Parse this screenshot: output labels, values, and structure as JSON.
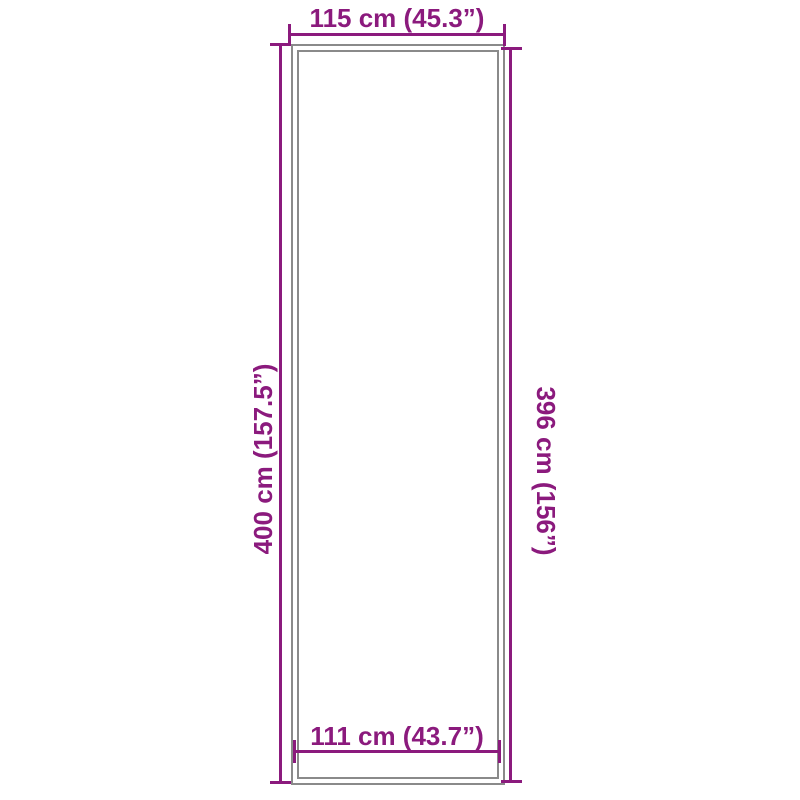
{
  "page": {
    "background_color": "#ffffff"
  },
  "diagram": {
    "type": "product-dimension-diagram",
    "accent_color": "#8B1A7D",
    "outline_color": "#8A8A8A",
    "shape": "tall-rectangle-with-double-outline",
    "dimensions": {
      "outer_width": {
        "position": "top",
        "label": "115 cm (45.3”)"
      },
      "outer_height": {
        "position": "left",
        "label": "400 cm (157.5”)"
      },
      "inner_height": {
        "position": "right",
        "label": "396 cm (156”)"
      },
      "inner_width": {
        "position": "bottom",
        "label": "111 cm (43.7”)"
      }
    }
  }
}
